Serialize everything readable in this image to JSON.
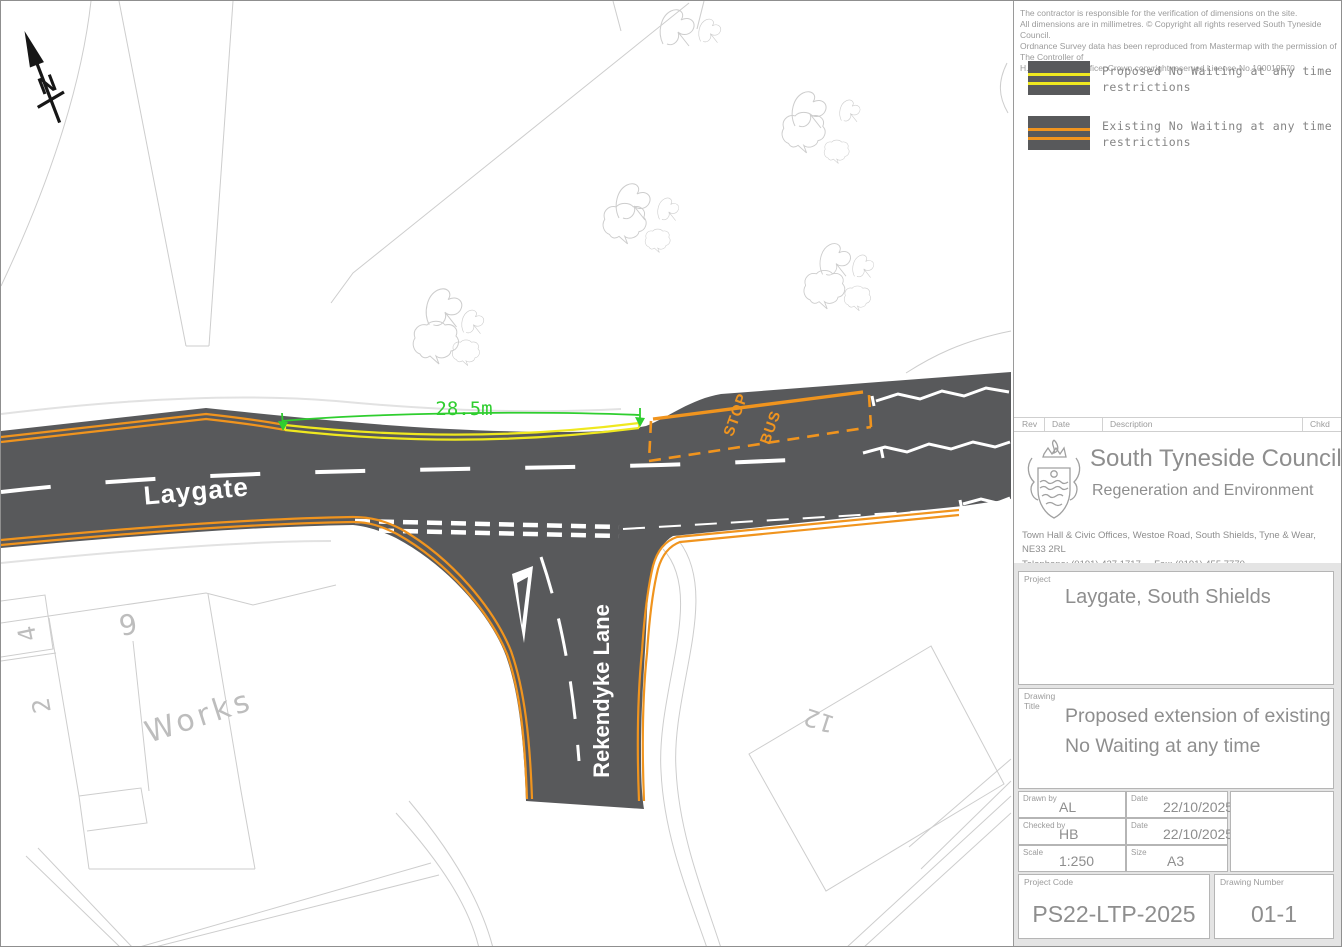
{
  "colors": {
    "road_surface": "#58595B",
    "existing_restriction_orange": "#F0941E",
    "proposed_restriction_yellow": "#EFE81F",
    "dimension_green": "#2FCE2F",
    "map_linework": "#CDCDCD",
    "map_text": "#BDBDBD",
    "road_marking_white": "#FFFFFF"
  },
  "map": {
    "street_label_main": "Laygate",
    "street_label_side": "Rekendyke Lane",
    "dimension_label": "28.5m",
    "bus_stop": {
      "line1": "BUS",
      "line2": "STOP"
    },
    "north_label": "N",
    "building_labels": {
      "works": "Works",
      "plot9": "9",
      "plot4": "4",
      "plot2": "2",
      "plot12": "12"
    }
  },
  "titleblock": {
    "disclaimer": [
      "The contractor is responsible for the verification of dimensions on the site.",
      "All dimensions are in millimetres.  © Copyright all rights reserved South Tyneside Council.",
      "Ordnance Survey data has been reproduced from Mastermap with the permission of The Controller of",
      "H.M. Stationery Office.  Crown copyright reserved.Licence-No.100019570"
    ],
    "legend": [
      {
        "label_line1": "Proposed No Waiting at any time",
        "label_line2": "restrictions"
      },
      {
        "label_line1": "Existing No Waiting at any time",
        "label_line2": "restrictions"
      }
    ],
    "rev_header": {
      "rev": "Rev",
      "date": "Date",
      "description": "Description",
      "chkd": "Chkd"
    },
    "council": {
      "name": "South Tyneside Council",
      "department": "Regeneration and Environment",
      "address": "Town Hall & Civic Offices, Westoe Road, South Shields, Tyne & Wear, NE33 2RL",
      "phone": "Telephone: (0191) 427 1717",
      "fax": "Fax: (0191) 455 7770"
    },
    "project": {
      "label": "Project",
      "value": "Laygate, South Shields"
    },
    "drawing_title": {
      "label": "Drawing Title",
      "value_line1": "Proposed extension of existing",
      "value_line2": "No Waiting at any time"
    },
    "fields": {
      "drawn_by": {
        "label": "Drawn by",
        "value": "AL"
      },
      "drawn_date": {
        "label": "Date",
        "value": "22/10/2025"
      },
      "checked_by": {
        "label": "Checked by",
        "value": "HB"
      },
      "checked_date": {
        "label": "Date",
        "value": "22/10/2025"
      },
      "scale": {
        "label": "Scale",
        "value": "1:250"
      },
      "size": {
        "label": "Size",
        "value": "A3"
      }
    },
    "project_code": {
      "label": "Project Code",
      "value": "PS22-LTP-2025"
    },
    "drawing_number": {
      "label": "Drawing Number",
      "value": "01-1"
    }
  }
}
